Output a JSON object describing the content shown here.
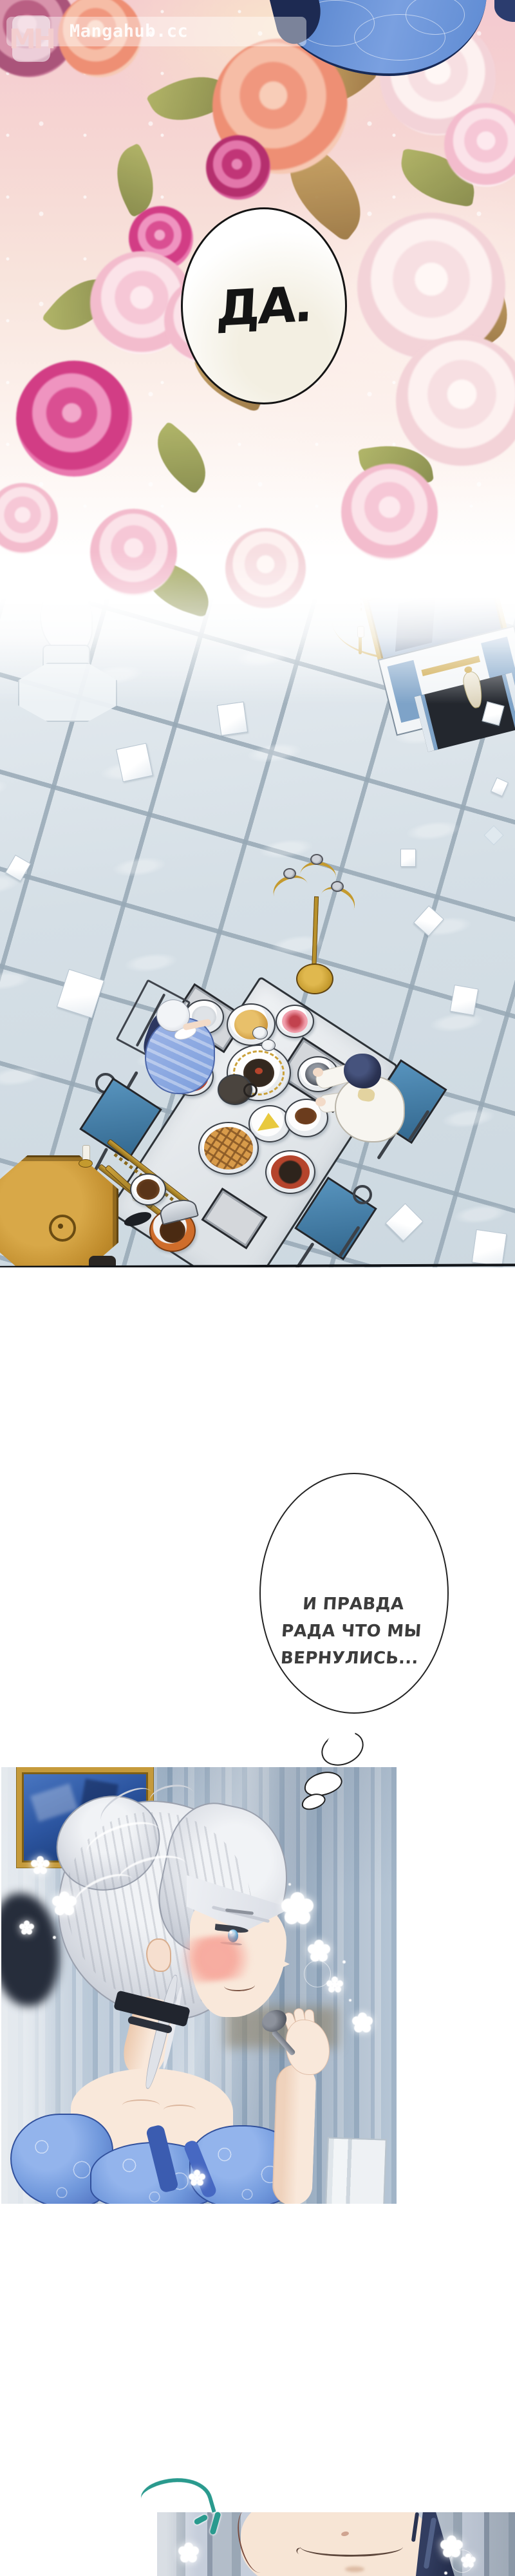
{
  "watermark": {
    "logo_text": "MH",
    "site_text": "Mangahub.cc"
  },
  "speech": {
    "yes_bubble": {
      "text": "ДА."
    },
    "thought_bubble": {
      "lines": [
        "И ПРАВДА",
        "РАДА ЧТО МЫ",
        "ВЕРНУЛИСЬ..."
      ]
    }
  },
  "effects": {
    "sound_mark": "teal-swoosh-accent"
  },
  "colors": {
    "page_bg": "#ffffff",
    "bubble_outline": "#1a1a1a",
    "flower_magenta": "#e0549a",
    "dress_blue": "#6f97db",
    "hair_silver": "#dfe2e8",
    "floor_tile": "#d5dfe6",
    "wallpaper_blue": "#a9bccf",
    "wood_gold": "#c08c2c",
    "sound_mark_teal": "#2a9a8e"
  }
}
